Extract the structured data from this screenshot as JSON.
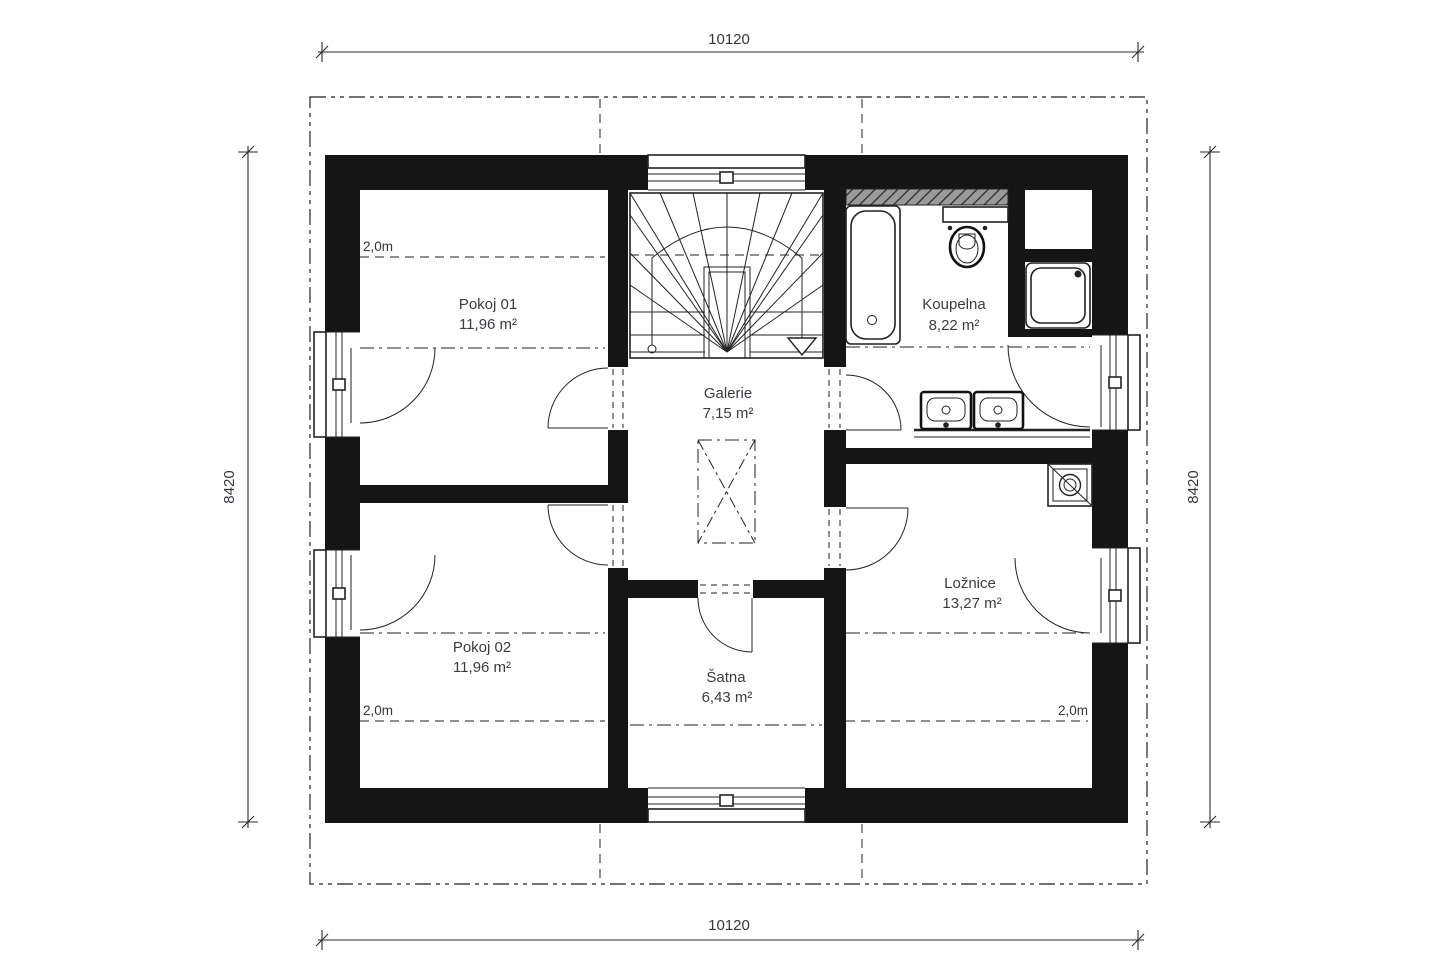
{
  "plan": {
    "type": "floor-plan",
    "rooms": [
      {
        "id": "pokoj-01",
        "name": "Pokoj 01",
        "area": "11,96 m²"
      },
      {
        "id": "pokoj-02",
        "name": "Pokoj 02",
        "area": "11,96 m²"
      },
      {
        "id": "galerie",
        "name": "Galerie",
        "area": "7,15 m²"
      },
      {
        "id": "satna",
        "name": "Šatna",
        "area": "6,43 m²"
      },
      {
        "id": "koupelna",
        "name": "Koupelna",
        "area": "8,22 m²"
      },
      {
        "id": "loznice",
        "name": "Ložnice",
        "area": "13,27 m²"
      }
    ],
    "dimensions": {
      "top": "10120",
      "bottom": "10120",
      "left": "8420",
      "right": "8420"
    },
    "height_lines": {
      "pokoj01": "2,0m",
      "pokoj02": "2,0m",
      "loznice": "2,0m"
    },
    "colors": {
      "wall": "#151515",
      "line": "#222222",
      "text": "#3b3b44",
      "background": "#ffffff"
    }
  }
}
